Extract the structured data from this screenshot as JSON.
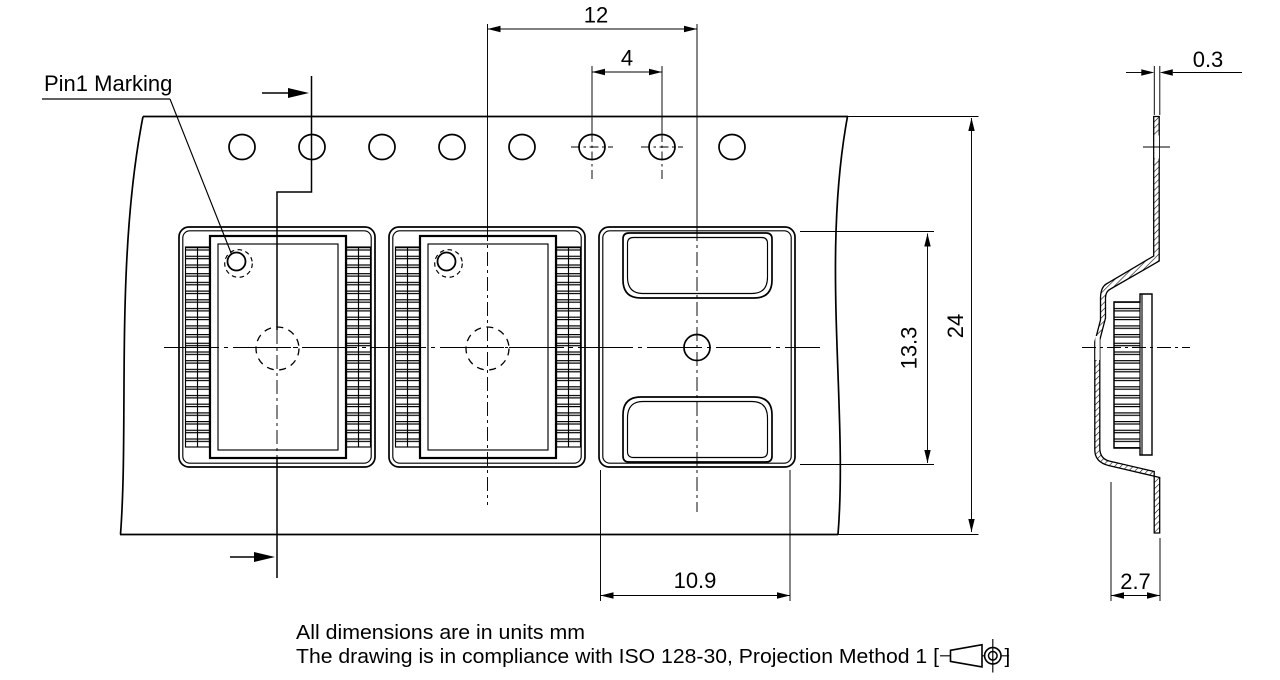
{
  "drawing": {
    "labels": {
      "pin1_marking": "Pin1 Marking"
    },
    "dimensions": {
      "pocket_pitch": "12",
      "sprocket_hole_pitch": "4",
      "tape_width": "24",
      "pocket_length": "13.3",
      "pocket_width": "10.9",
      "pocket_depth": "2.7",
      "tape_thickness": "0.3"
    },
    "notes": {
      "line1": "All dimensions are in units mm",
      "line2_prefix": "The drawing is in compliance with ISO 128-30, Projection Method 1 [",
      "line2_suffix": "]"
    },
    "icons": {
      "projection_method": "first-angle-projection-icon"
    },
    "colors": {
      "line": "#000000",
      "background": "#ffffff"
    }
  }
}
